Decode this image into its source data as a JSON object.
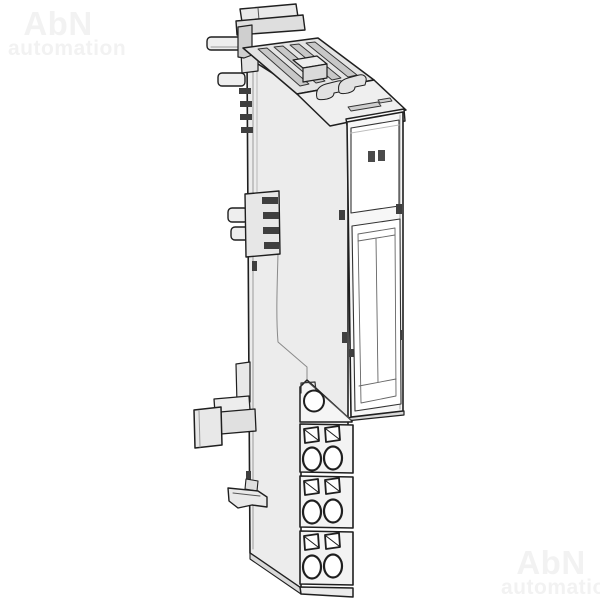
{
  "watermarks": {
    "top_left": {
      "line1": "AbN",
      "line2": "automation"
    },
    "bottom_right": {
      "line1": "AbN",
      "line2": "automation"
    },
    "color": "#f2f2f2"
  },
  "illustration": {
    "subject": "Slim DIN-rail I/O terminal module, isometric technical line drawing",
    "colors": {
      "outline": "#1f1f1f",
      "body": "#ececec",
      "panel": "#ffffff",
      "dark_detail": "#3f3f3f",
      "led": "#4a4a4a"
    },
    "visible_features": {
      "status_leds": 2,
      "terminal_sections": 3,
      "wire_holes_per_section": 2,
      "release_buttons_per_section": 2,
      "side_contact_pins": 4
    }
  }
}
